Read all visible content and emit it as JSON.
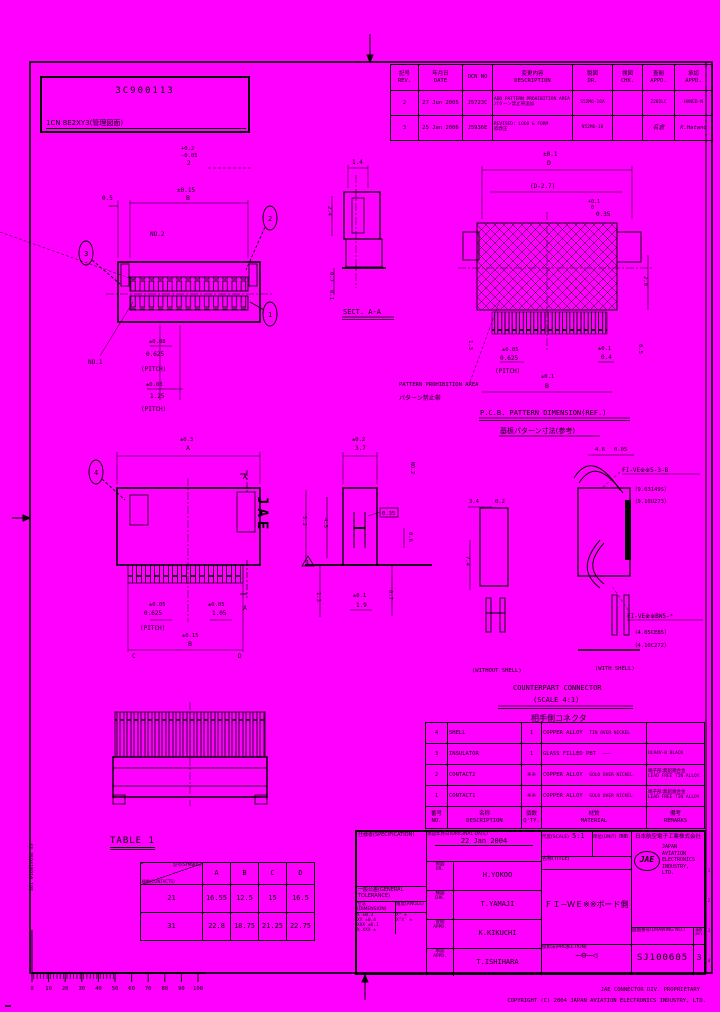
{
  "page": {
    "bg": "#FF00FF",
    "ink": "#000000"
  },
  "stamp": {
    "line1": "3C900113",
    "line2": "1CN 8E2XY3(管理図面)"
  },
  "revision_table": {
    "headers": {
      "rev_jp": "記号",
      "rev_en": "REV.",
      "date_jp": "年月日",
      "date_en": "DATE",
      "dcn": "DCN NO",
      "desc_jp": "変更内容",
      "desc_en": "DESCRIPTION",
      "dr_jp": "製図",
      "dr_en": "DR.",
      "chk_jp": "検図",
      "chk_en": "CHK.",
      "appd_jp": "査閲",
      "appd_en": "APPD.",
      "appl_jp": "承認",
      "appl_en": "APPD."
    },
    "rows": [
      {
        "rev": "2",
        "date": "27 Jun 2005",
        "dcn": "J5723C",
        "desc1": "ADD PATTERN PROHIBITION AREA",
        "desc2": "パターン禁止帯追加",
        "dr": "S52M6-10A",
        "chk": "",
        "appd": "2202LC",
        "appl": "HANED-N"
      },
      {
        "rev": "3",
        "date": "25 Jan 2006",
        "dcn": "J5936E",
        "desc1": "REVISED: LOGO & FORM",
        "desc2": "枠改正",
        "dr": "N52M6-10",
        "chk": "",
        "appd": "名倉",
        "appl": "K.Hatano"
      }
    ]
  },
  "front_view": {
    "balloon1": "1",
    "balloon2": "2",
    "balloon3": "3",
    "d05": "0.5",
    "tol_p": "+0.2",
    "tol_m": "-0.05",
    "len2": "2",
    "tolB": "±0.15",
    "B": "B",
    "no2": "NO.2",
    "no1": "NO.1",
    "p1tol": "±0.08",
    "p1": "0.625",
    "p1lbl": "(PITCH)",
    "p2tol": "±0.08",
    "p2": "1.25",
    "p2lbl": "(PITCH)"
  },
  "sect_aa": {
    "label": "SECT. A-A",
    "d14": "1.4",
    "d24": "2.4",
    "d07": "0.7",
    "d01": "0.1"
  },
  "pcb_view": {
    "title_en": "P.C.B. PATTERN DIMENSION(REF.)",
    "title_jp": "基板パターン寸法(参考)",
    "note_en": "PATTERN PROHIBITION AREA",
    "note_jp": "パターン禁止帯",
    "tolD": "±0.1",
    "D": "D",
    "dm27": "(D-2.7)",
    "padtol_p": "+0.1",
    "padtol_m": "0",
    "pad": "0.35",
    "d20": "2.0",
    "d13": "1.3",
    "d05": "0.5",
    "ptol": "±0.05",
    "pitch": "0.625",
    "pitch_lbl": "(PITCH)",
    "tolB": "±0.1",
    "B": "B",
    "tol04": "±0.1",
    "d04": "0.4"
  },
  "top_view": {
    "balloon4": "4",
    "logo": "JAE",
    "sectA1": "A",
    "sectA2": "A",
    "tolA": "±0.3",
    "A": "A",
    "ptol": "±0.05",
    "pitch": "0.625",
    "pitch_lbl": "(PITCH)",
    "qtol": "±0.05",
    "q": "1.05",
    "tolB": "±0.15",
    "B": "B",
    "C": "C",
    "D": "D"
  },
  "mid_section": {
    "tol37": "±0.2",
    "d37": "3.7",
    "d035": "0.35",
    "d52": "5.2",
    "d45": "4.5",
    "d06": "0.6",
    "d13": "1.3",
    "tol19": "±0.1",
    "d19": "1.9",
    "d07": "0.7",
    "no2": "NO.2",
    "delta": "1"
  },
  "counterpart": {
    "title_en": "COUNTERPART CONNECTOR",
    "scale": "(SCALE 4:1)",
    "title_jp": "相手側コネクタ",
    "cap_left": "(WITHOUT SHELL)",
    "cap_right": "(WITH SHELL)",
    "label_top": "FI-VE※※5-3-B",
    "label_top_s1": "〔9.03149S〕",
    "label_top_s2": "〔9.10U273〕",
    "label_bot": "FI-VE※※BW5-*",
    "label_bot_s1": "〔4.05CEB5〕",
    "label_bot_s2": "〔4.10C272〕",
    "d46": "4.6",
    "d005": "0.05",
    "d34": "3.4",
    "d02": "0.2",
    "d74": "7.4"
  },
  "table1": {
    "title": "TABLE 1",
    "corner_top": "記号(SYMBOL)",
    "corner_bottom": "極数(CONTACTS)",
    "cols": [
      "A",
      "B",
      "C",
      "D"
    ],
    "rows": [
      {
        "n": "21",
        "A": "16.55",
        "B": "12.5",
        "C": "15",
        "D": "16.5"
      },
      {
        "n": "31",
        "A": "22.8",
        "B": "18.75",
        "C": "21.25",
        "D": "22.75"
      }
    ]
  },
  "parts_list": {
    "headers": {
      "no_jp": "番号",
      "no_en": "NO.",
      "desc_jp": "名称",
      "desc_en": "DESCRIPTION",
      "qty_jp": "個数",
      "qty_en": "Q'TY.",
      "mat_jp": "材質",
      "mat_en": "MATERIAL",
      "rem_jp": "備考",
      "rem_en": "REMARKS"
    },
    "rows": [
      {
        "no": "4",
        "name": "SHELL",
        "qty": "1",
        "mat": "COPPER ALLOY",
        "fin": "TIN OVER NICKEL",
        "rem1": "",
        "rem2": ""
      },
      {
        "no": "3",
        "name": "INSULATOR",
        "qty": "1",
        "mat": "GLASS FILLED PBT",
        "fin": "———",
        "rem1": "UL94V-0 BLACK",
        "rem2": ""
      },
      {
        "no": "2",
        "name": "CONTACT2",
        "qty": "※※",
        "mat": "COPPER ALLOY",
        "fin": "GOLD OVER NICKEL",
        "rem1": "端子部:無鉛錫合金",
        "rem2": "LEAD FREE TIN ALLOY"
      },
      {
        "no": "1",
        "name": "CONTACT1",
        "qty": "※※",
        "mat": "COPPER ALLOY",
        "fin": "GOLD OVER NICKEL",
        "rem1": "端子部:無鉛錫合金",
        "rem2": "LEAD FREE TIN ALLOY"
      }
    ]
  },
  "title_block": {
    "spec_label": "仕様書(SPECIFICATION)",
    "tol_title": "一般公差(GENERAL TOLERANCE)",
    "tol_col_dim": "寸法(DIMENSION)",
    "tol_col_ang": "角度(ANGLE)",
    "tol_rows": [
      {
        "dim": "X ±0.3",
        "ang": "X° ±"
      },
      {
        "dim": "XX ±0.4",
        "ang": "X°X′ ±"
      },
      {
        "dim": "XXX ±0.1",
        "ang": ""
      },
      {
        "dim": "X.XXX ±",
        "ang": ""
      }
    ],
    "date_label": "承認年月日(ORIGINAL DATE)",
    "date_value": "22 Jan 2004",
    "sign_rows": [
      {
        "jp": "製図",
        "en": "DR.",
        "name": "H.YOKOO"
      },
      {
        "jp": "検図",
        "en": "CHK.",
        "name": "T.YAMAJI"
      },
      {
        "jp": "査閲",
        "en": "APPD.",
        "name": "K.KIKUCHI"
      },
      {
        "jp": "承認",
        "en": "APPD.",
        "name": "T.ISHIHARA"
      }
    ],
    "scale_label": "尺度(SCALE)",
    "scale_value": "5:1",
    "unit_label": "単位(UNIT)",
    "unit_value": "mm",
    "title_label": "名称(TITLE)",
    "title_value": "ＦＩ−ＷＥ※※ボード側",
    "proj_label": "投影法(PROJECTION)",
    "proj_symbol": "—⊖—◁",
    "company_jp": "日本航空電子工業株式会社",
    "logo": "JAE",
    "company_en1": "JAPAN AVIATION",
    "company_en2": "ELECTRONICS",
    "company_en3": "INDUSTRY, LTD.",
    "dwg_label": "図面番号(DRAWING NO.)",
    "dwg_value": "SJ100605",
    "rev_label": "版数",
    "rev_label2": "(REV.)",
    "rev_value": "3"
  },
  "footer": {
    "line1": "JAE CONNECTOR DIV. PROPRIETARY",
    "line2": "COPYRIGHT (C) 2004  JAPAN AVIATION ELECTRONICS INDUSTRY, LTD."
  },
  "ruler": {
    "ticks": [
      "0",
      "10",
      "20",
      "30",
      "40",
      "50",
      "60",
      "70",
      "80",
      "90",
      "100"
    ]
  },
  "edge_code": "43-35941B910-195",
  "edge_strip": [
    "1",
    "2",
    "3",
    "4"
  ]
}
